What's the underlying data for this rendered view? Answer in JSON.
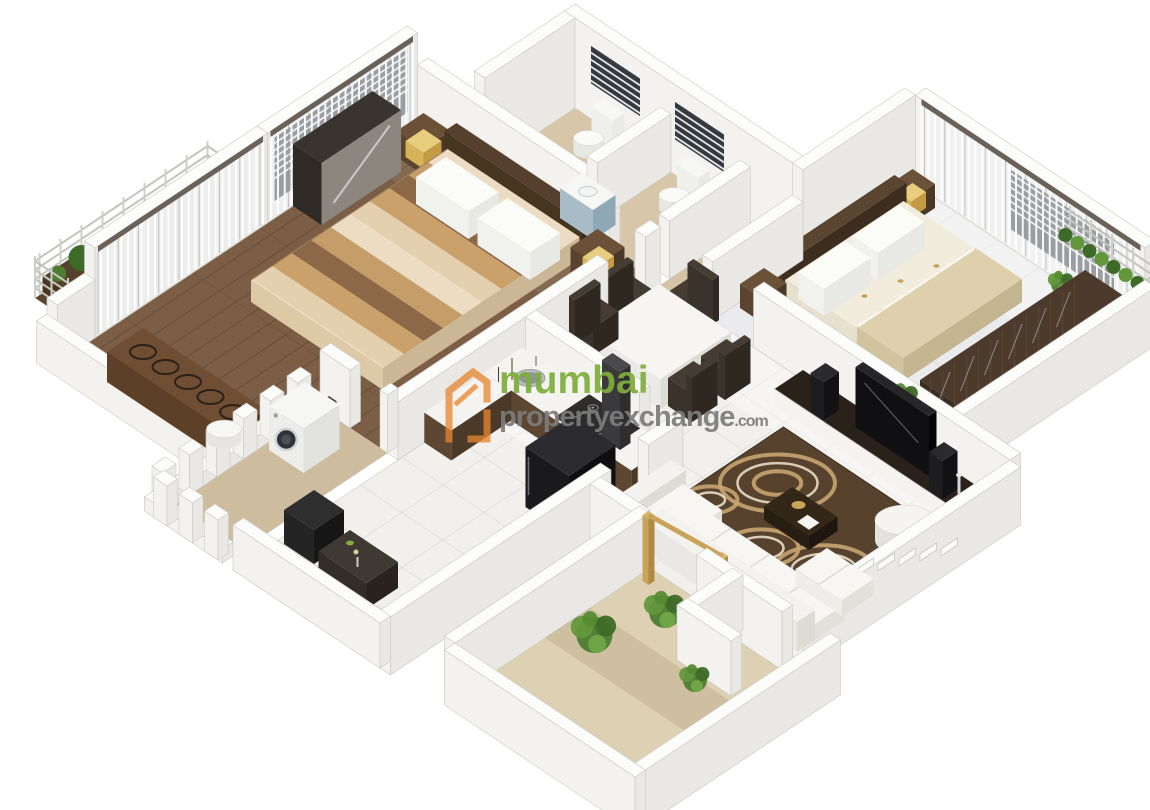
{
  "watermark": {
    "logo": "house-icon",
    "line1": "mumbai",
    "line2": "propertyexchange",
    "tld": ".com"
  },
  "palette": {
    "brand_orange": "#E8862F",
    "brand_green": "#7FAE3B",
    "brand_gray": "#7C7C7C",
    "wall_top": "#FCFCFB",
    "wall_face_u": "#E9E8E4",
    "wall_face_v": "#F3F2EF",
    "wood_floor": "#7B5E45",
    "balcony_wood": "#5A452F",
    "tile_beige": "#D8C6A9",
    "tile_white": "#F1F0ED",
    "gloss_tile": "#EBEBED",
    "courtyard_sand": "#DDD0B3",
    "rug_brown": "#57422E",
    "rug_swirl_tan": "#C8A471",
    "rug_swirl_cream": "#E9DDC6",
    "dark_furniture": "#3A2D22",
    "black_appliance": "#1A1A1E",
    "counter_brown": "#5D4732",
    "accent_gold": "#C9A35A",
    "plant_green": "#5E9136",
    "glass_dark": "#343A40",
    "bed_stripe_tan": "#C59D68",
    "bed_stripe_brown": "#8C6848",
    "bed_cream": "#ECDCC3"
  }
}
